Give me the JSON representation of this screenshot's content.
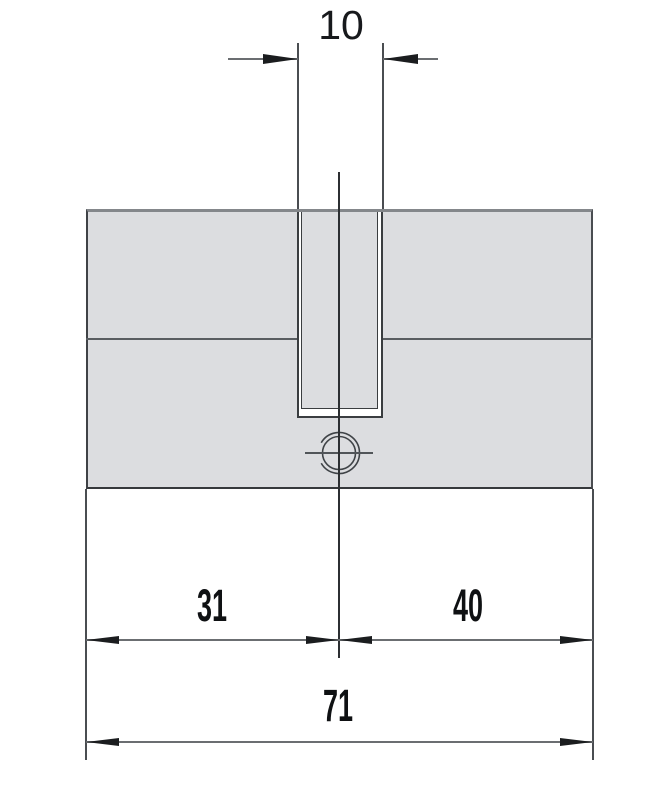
{
  "diagram": {
    "type": "technical-dimension-drawing",
    "subject": "double profile lock cylinder, front view",
    "labels": {
      "cam_slot_width": "10",
      "left_length": "31",
      "right_length": "40",
      "overall_length": "71"
    },
    "colors": {
      "background": "#ffffff",
      "body_fill": "#dcdde0",
      "outline_dark": "#3a3d40",
      "outline_gray": "#84878b",
      "dimension_line": "#6b6e71",
      "arrow_and_text": "#17191c"
    }
  }
}
